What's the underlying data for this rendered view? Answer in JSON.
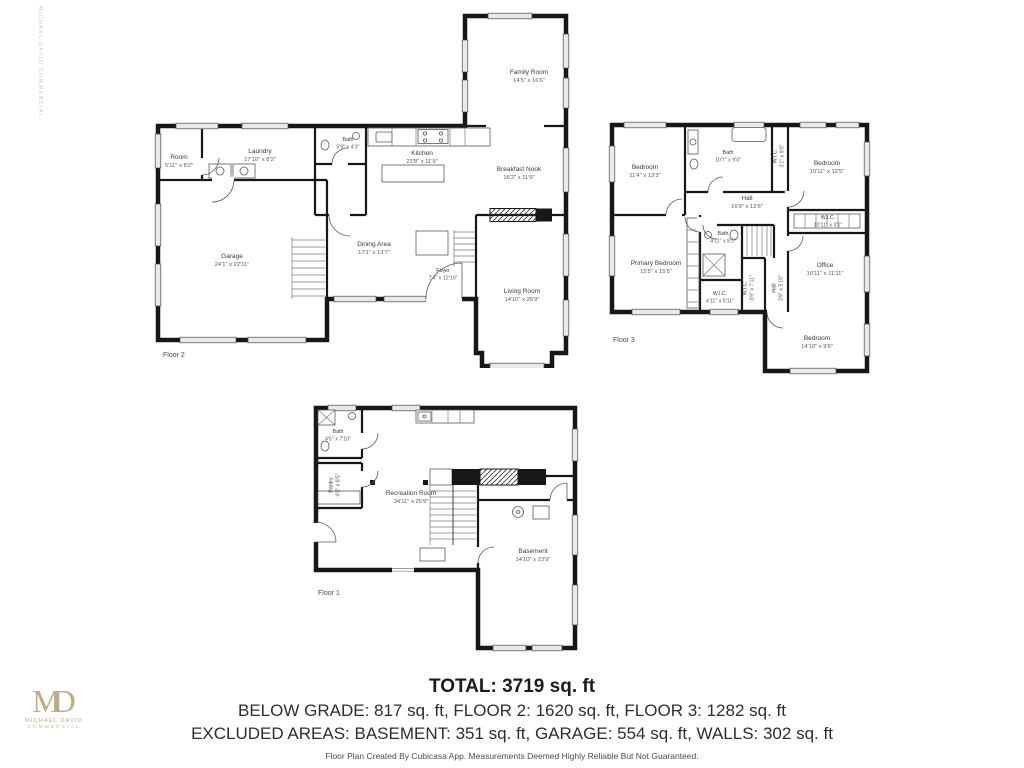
{
  "floors": {
    "floor2": {
      "label": "Floor 2",
      "rooms": {
        "family_room": {
          "name": "Family Room",
          "dims": "14'5\" x 16'6\""
        },
        "room": {
          "name": "Room",
          "dims": "5'11\" x 8'2\""
        },
        "laundry": {
          "name": "Laundry",
          "dims": "17'10\" x 8'2\""
        },
        "bath": {
          "name": "Bath",
          "dims": "5'9\" x 4'3\""
        },
        "kitchen": {
          "name": "Kitchen",
          "dims": "23'8\" x 11'9\""
        },
        "breakfast_nook": {
          "name": "Breakfast Nook",
          "dims": "16'2\" x 11'9\""
        },
        "garage": {
          "name": "Garage",
          "dims": "24'1\" x 22'11\""
        },
        "dining_area": {
          "name": "Dining Area",
          "dims": "17'1\" x 13'7\""
        },
        "foyer": {
          "name": "Foyer",
          "dims": "7'4\" x 12'10\""
        },
        "living_room": {
          "name": "Living Room",
          "dims": "14'10\" x 25'9\""
        }
      }
    },
    "floor3": {
      "label": "Floor 3",
      "rooms": {
        "bedroom_nw": {
          "name": "Bedroom",
          "dims": "11'4\" x 13'3\""
        },
        "bath_top": {
          "name": "Bath",
          "dims": "10'7\" x 9'0\""
        },
        "wic_top": {
          "name": "W.I.C.",
          "dims": "3'1\" x 9'0\""
        },
        "bedroom_ne": {
          "name": "Bedroom",
          "dims": "10'11\" x 12'5\""
        },
        "hall": {
          "name": "Hall",
          "dims": "16'9\" x 12'6\""
        },
        "wic_right": {
          "name": "W.I.C.",
          "dims": "10'11\" x 3'1\""
        },
        "office": {
          "name": "Office",
          "dims": "10'11\" x 11'11\""
        },
        "primary_bedroom": {
          "name": "Primary Bedroom",
          "dims": "15'5\" x 15'5\""
        },
        "bath_mid": {
          "name": "Bath",
          "dims": "4'11\" x 8'2\""
        },
        "wic_mid": {
          "name": "W.I.C.",
          "dims": "4'11\" x 5'11\""
        },
        "wic_vert": {
          "name": "W.I.C.",
          "dims": "3'9\" x 7'11\""
        },
        "hall_vert": {
          "name": "Hall",
          "dims": "3'9\" x 5'10\""
        },
        "bedroom_se": {
          "name": "Bedroom",
          "dims": "14'10\" x 9'6\""
        }
      }
    },
    "floor1": {
      "label": "Floor 1",
      "rooms": {
        "bath": {
          "name": "Bath",
          "dims": "4'5\" x 7'10\""
        },
        "pantry": {
          "name": "Pantry",
          "dims": "4'5\" x 8'5\""
        },
        "recreation_room": {
          "name": "Recreation Room",
          "dims": "34'11\" x 25'9\""
        },
        "basement": {
          "name": "Basement",
          "dims": "14'10\" x 23'9\""
        }
      }
    }
  },
  "summary": {
    "total": "TOTAL: 3719 sq. ft",
    "line2": "BELOW GRADE: 817 sq. ft, FLOOR 2: 1620 sq. ft, FLOOR 3: 1282 sq. ft",
    "line3": "EXCLUDED AREAS: BASEMENT: 351 sq. ft, GARAGE: 554 sq. ft, WALLS: 302 sq. ft",
    "disclaimer": "Floor Plan Created By Cubicasa App. Measurements Deemed Highly Reliable But Not Guaranteed."
  },
  "branding": {
    "monogram": "MD",
    "name": "MICHAEL DAVID",
    "subtitle": "COMMERCIAL",
    "watermark": "MICHAEL DAVID COMMERCIAL",
    "gold": "#b6a77b"
  }
}
